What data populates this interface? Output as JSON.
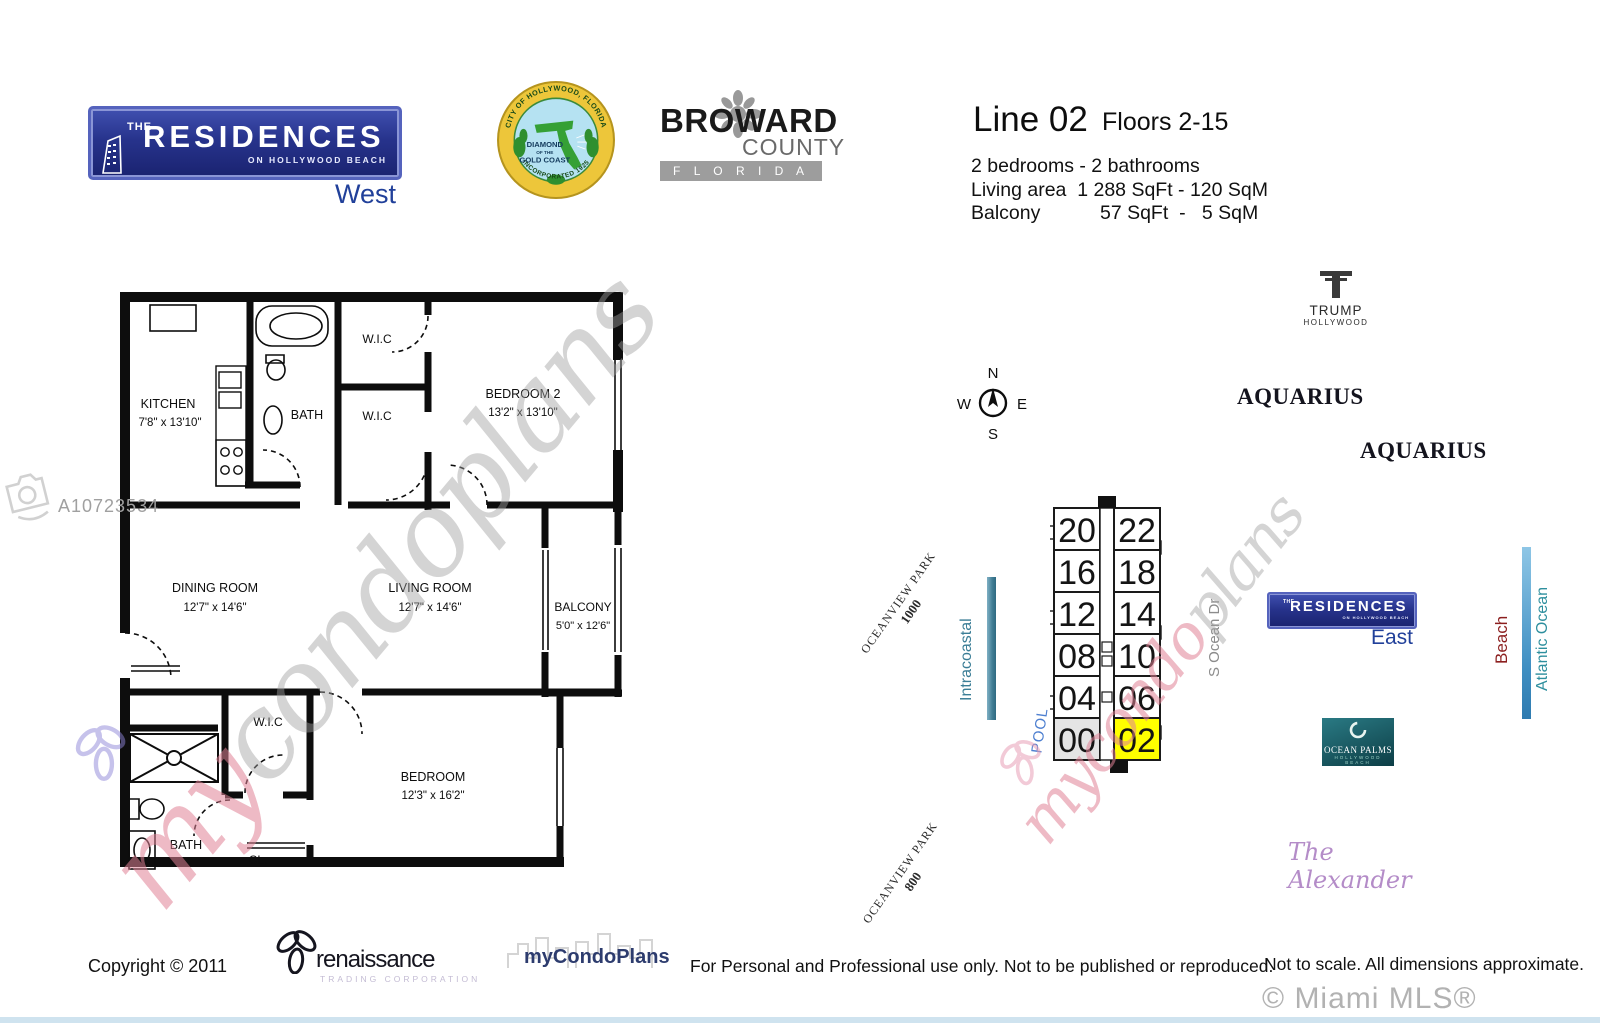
{
  "title_block": {
    "line_title": "Line 02",
    "floors": "Floors 2-15",
    "spec_line1": "2 bedrooms - 2 bathrooms",
    "spec_line2": "Living area  1 288 SqFt - 120 SqM",
    "spec_line3": "Balcony           57 SqFt  -   5 SqM"
  },
  "logos": {
    "residences_west": {
      "the": "THE",
      "name": "RESIDENCES",
      "tagline": "ON HOLLYWOOD BEACH",
      "region": "West"
    },
    "residences_east": {
      "the": "THE",
      "name": "RESIDENCES",
      "tagline": "ON HOLLYWOOD BEACH",
      "region": "East"
    },
    "hollywood_seal": {
      "arc_top": "CITY OF HOLLYWOOD, FLORIDA",
      "center1": "DIAMOND",
      "center2": "OF THE",
      "center3": "GOLD COAST",
      "arc_bottom": "INCORPORATED 1925"
    },
    "broward": {
      "name": "BROWARD",
      "county": "COUNTY",
      "state": "F L O R I D A"
    },
    "trump": {
      "name": "TRUMP",
      "sub": "HOLLYWOOD"
    },
    "ocean_palms": {
      "name": "OCEAN PALMS",
      "sub": "HOLLYWOOD BEACH"
    },
    "renaissance": {
      "name": "renaissance",
      "sub": "TRADING CORPORATION"
    },
    "mycondoplans": "myCondoPlans"
  },
  "floorplan": {
    "kitchen": {
      "name": "KITCHEN",
      "dims": "7'8\" x 13'10\""
    },
    "bath_upper": {
      "name": "BATH"
    },
    "wic_upper_1": {
      "name": "W.I.C"
    },
    "wic_upper_2": {
      "name": "W.I.C"
    },
    "bedroom2": {
      "name": "BEDROOM 2",
      "dims": "13'2\" x 13'10\""
    },
    "dining": {
      "name": "DINING ROOM",
      "dims": "12'7\" x 14'6\""
    },
    "living": {
      "name": "LIVING ROOM",
      "dims": "12'7\" x 14'6\""
    },
    "balcony": {
      "name": "BALCONY",
      "dims": "5'0\" x 12'6\""
    },
    "wic_lower": {
      "name": "W.I.C"
    },
    "bedroom": {
      "name": "BEDROOM",
      "dims": "12'3\" x 16'2\""
    },
    "bath_lower": {
      "name": "BATH"
    },
    "closet": {
      "name": "CL."
    }
  },
  "map": {
    "aquarius_1": "AQUARIUS",
    "aquarius_2": "AQUARIUS",
    "alexander": "The Alexander",
    "oceanview_north": {
      "line1": "OCEANVIEW PARK",
      "line2": "1000"
    },
    "oceanview_south": {
      "line1": "OCEANVIEW PARK",
      "line2": "800"
    },
    "intracoastal": "Intracoastal",
    "pool": "POOL",
    "street": "S Ocean Dr",
    "beach": "Beach",
    "ocean": "Atlantic Ocean",
    "compass": {
      "n": "N",
      "e": "E",
      "s": "S",
      "w": "W"
    },
    "stack": {
      "rows": [
        [
          "20",
          "22"
        ],
        [
          "16",
          "18"
        ],
        [
          "12",
          "14"
        ],
        [
          "08",
          "10"
        ],
        [
          "04",
          "06"
        ],
        [
          "00",
          "02"
        ]
      ],
      "highlighted_unit": "02"
    }
  },
  "watermarks": {
    "mls_number": "A10723534",
    "script_left": {
      "part1": "my",
      "part2": "condoplans"
    },
    "script_right": {
      "part1": "mycondo",
      "part2": "plans"
    }
  },
  "footer": {
    "copyright": "Copyright © 2011",
    "legal": "For Personal and Professional use only.  Not to be published or reproduced.",
    "disclaimer": "Not to scale.  All dimensions approximate.",
    "mls_credit": "© Miami MLS® 08/2019"
  },
  "colors": {
    "logo_blue": "#27338c",
    "highlight_yellow": "#ffff00",
    "intracoastal_teal": "#3a7d96",
    "beach_red": "#8c1f1f",
    "ocean_teal": "#2e8f9e",
    "pool_blue": "#4d7fd0",
    "alexander_purple": "#b48cc8"
  }
}
